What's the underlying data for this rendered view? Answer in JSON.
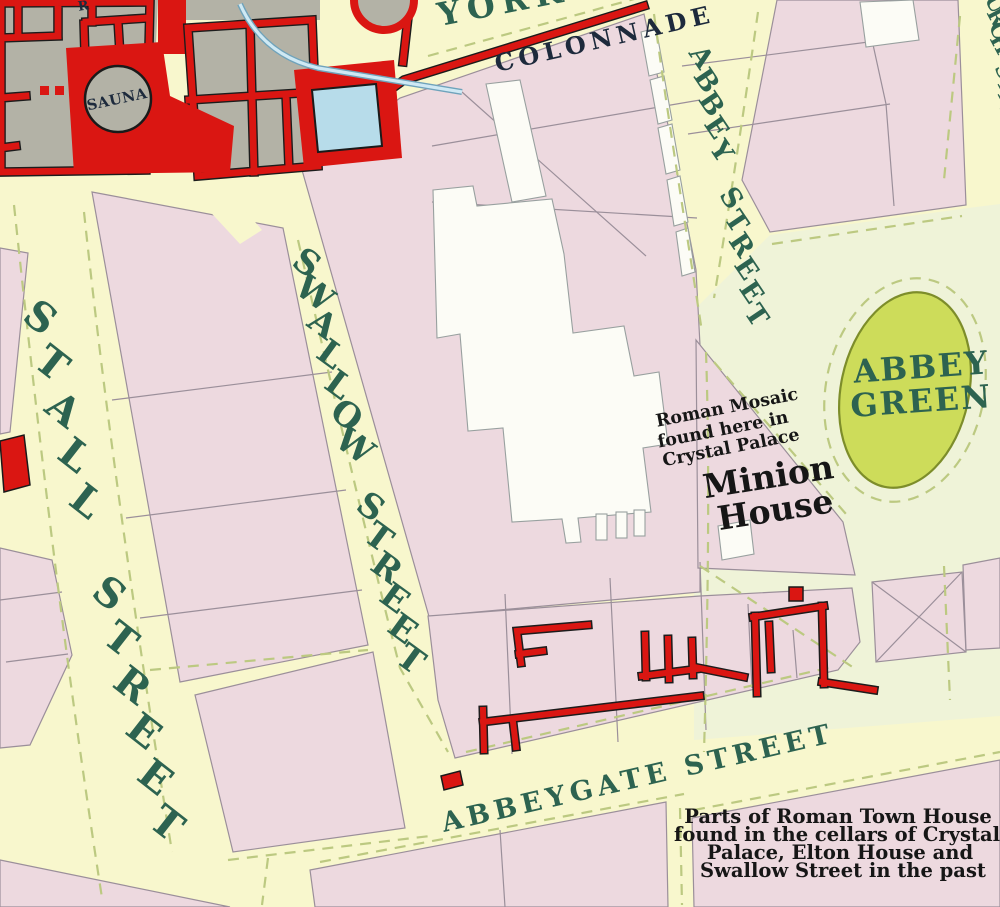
{
  "map": {
    "colors": {
      "street_yellow": "#f8f7cd",
      "abbey_area_green": "#eff3d8",
      "block_pink": "#edd9df",
      "roman_red": "#da1612",
      "baths_gray": "#b3b2a6",
      "pool_blue": "#b7dcea",
      "green_ellipse": "#cddc5a",
      "street_text_green": "#2d6350",
      "annotation_black": "#161616"
    },
    "labels": {
      "york": "YORK",
      "colonnade": "COLONNADE",
      "sauna": "SAUNA",
      "abbeygate_street": "ABBEYGATE STREET",
      "abbey_green": [
        "ABBEY",
        "GREEN"
      ],
      "mosaic_note": [
        "Roman Mosaic",
        "found here in",
        "Crystal Palace"
      ],
      "minion_house": [
        "Minion",
        "House"
      ],
      "caption": [
        "Parts of Roman Town House",
        "found in the cellars of Crystal",
        "Palace, Elton House and",
        "Swallow Street in the past"
      ],
      "edge_fragment": "R"
    },
    "letter_labels": [
      {
        "name": "stall-street",
        "text": "STALL STREET",
        "x": 32,
        "y": 328,
        "dx": 11.5,
        "dy": 46,
        "rot": 38,
        "size": 40
      },
      {
        "name": "swallow-street",
        "text": "SWALLOW STREET",
        "x": 300,
        "y": 272,
        "dx": 8,
        "dy": 30.5,
        "rot": 36,
        "size": 34
      },
      {
        "name": "abbey-street",
        "text": "ABBEY STREET",
        "x": 694,
        "y": 62,
        "dx": 5,
        "dy": 23.5,
        "rot": 56,
        "size": 27
      },
      {
        "name": "church-street",
        "text": "CHURCH STREET",
        "x": 985,
        "y": -20,
        "dx": 1.8,
        "dy": 13.5,
        "rot": 62,
        "size": 21
      }
    ]
  }
}
